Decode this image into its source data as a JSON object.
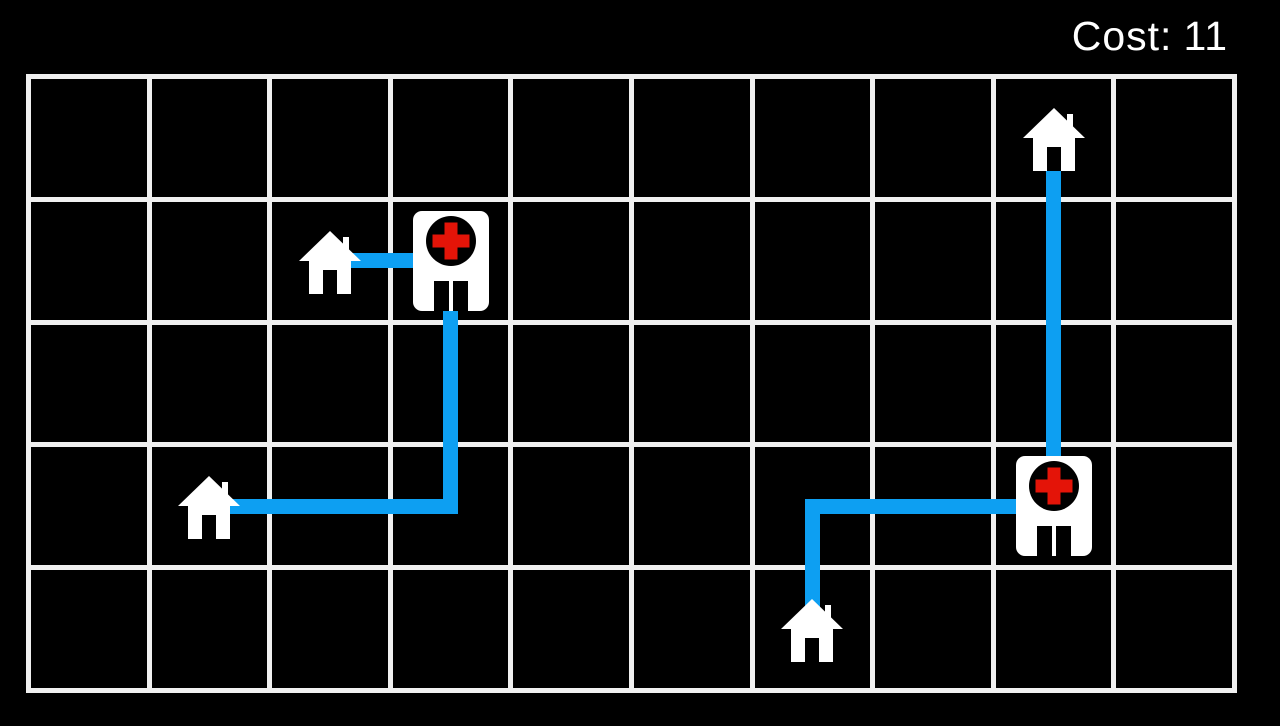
{
  "hud": {
    "cost_label": "Cost:",
    "cost_value": "11"
  },
  "board": {
    "rows": 5,
    "cols": 10,
    "houses": [
      {
        "col": 2,
        "row": 1
      },
      {
        "col": 1,
        "row": 3
      },
      {
        "col": 8,
        "row": 0
      },
      {
        "col": 6,
        "row": 4
      }
    ],
    "hospitals": [
      {
        "col": 3,
        "row": 1
      },
      {
        "col": 8,
        "row": 3
      }
    ],
    "roads": [
      {
        "name": "road-house-to-hospital-left-short",
        "points": [
          [
            2,
            1
          ],
          [
            3,
            1
          ]
        ]
      },
      {
        "name": "road-house-to-hospital-left-long",
        "points": [
          [
            1,
            3
          ],
          [
            3,
            3
          ],
          [
            3,
            1
          ]
        ]
      },
      {
        "name": "road-house-to-hospital-right-vertical",
        "points": [
          [
            8,
            0
          ],
          [
            8,
            3
          ]
        ]
      },
      {
        "name": "road-house-to-hospital-right-elbow",
        "points": [
          [
            6,
            4
          ],
          [
            6,
            3
          ],
          [
            8,
            3
          ]
        ]
      }
    ]
  },
  "colors": {
    "background": "#000000",
    "grid_line": "#f0f0f0",
    "road_blue": "#0d9ff2",
    "icon_white": "#ffffff",
    "icon_black": "#000000",
    "cross_red": "#e41408",
    "text": "#ffffff"
  }
}
